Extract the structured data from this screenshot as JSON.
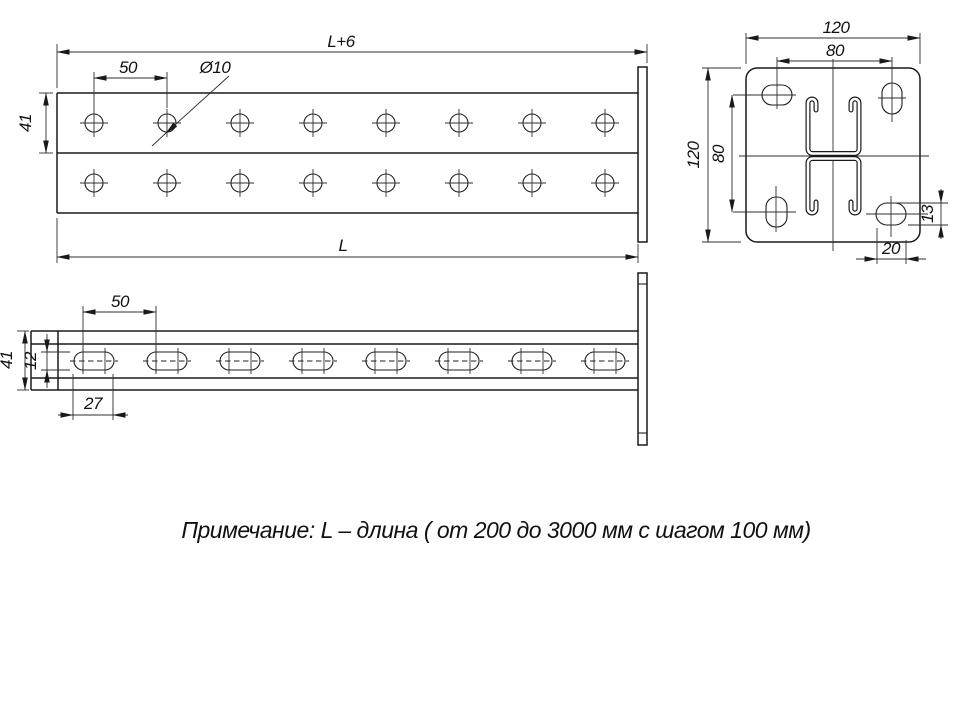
{
  "drawing": {
    "note": "Примечание: L – длина ( от 200 до 3000 мм с шагом 100 мм)",
    "front_view": {
      "dim_overall_length": "L+6",
      "dim_hole_pitch": "50",
      "dim_hole_diameter": "Ø10",
      "dim_row_height": "41",
      "dim_length": "L"
    },
    "section_view": {
      "dim_plate_width": "120",
      "dim_slot_pitch_horizontal": "80",
      "dim_plate_height": "120",
      "dim_slot_pitch_vertical": "80",
      "dim_slot_height": "13",
      "dim_slot_width": "20"
    },
    "side_view": {
      "dim_slot_pitch": "50",
      "dim_height": "41",
      "dim_slot_height": "12",
      "dim_slot_length": "27"
    }
  }
}
